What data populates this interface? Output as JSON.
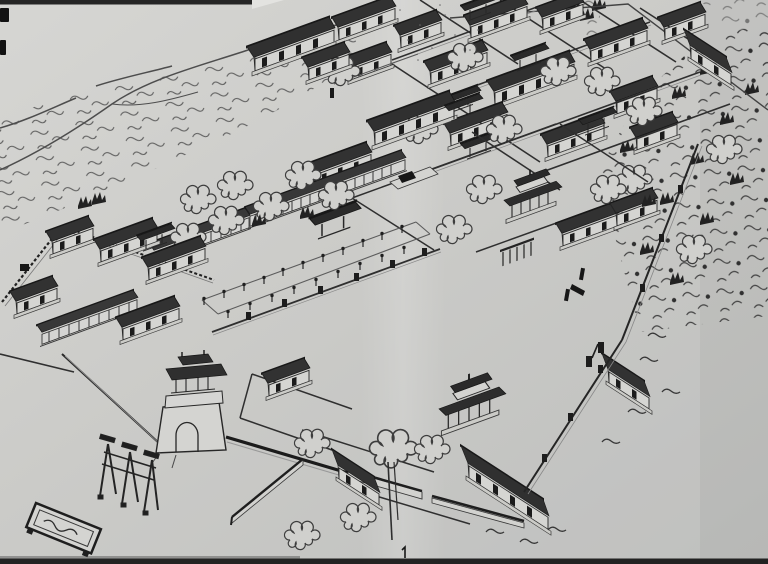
{
  "scene": {
    "aria_label": "Black-and-white photograph of a hand-drawn bird's-eye ink illustration of a traditional Chinese temple complex",
    "description": "Axonometric pen drawing on a book page: walled courtyards on a diagonal axis, approach avenue lined with small posts and side galleries, main gate tower with arched passage, memorial archway, spirit screen, hills at upper left, dense woodland at right",
    "visible_text": [],
    "labels": {
      "paper": "book page paper",
      "fold": "page curvature highlight",
      "photo_edges": "dark photo edge bands",
      "hills": "hill contour lines",
      "scrub": "hillside scrub texture",
      "woods": "dense woodland",
      "frame": "drawing border line",
      "upper_complex": "grid of walled courtyards with halls",
      "middle_complex": "central courtyards with halls",
      "gate_hall": "second gate hall with platform",
      "central_pavilion": "double-eaved central pavilion",
      "avenue": "approach avenue lined with posts",
      "galleries": "side gallery buildings",
      "steles": "small stele markers",
      "left_compound": "walled compound with crenellated wall",
      "gate_tower": "main gate tower with arched passage",
      "paifang": "memorial archway (paifang)",
      "screen_wall": "spirit screen wall",
      "front_walls": "front enclosure walls",
      "lower_complex": "lower courtyards and halls",
      "garden_pavilion": "double-eaved pavilion in lower court",
      "east_wall": "outer boundary wall with piers",
      "big_tree": "large tree with trunk",
      "mark_1": "small stray mark resembling numeral 1"
    },
    "colors": {
      "paper": "#cfcfcc",
      "paper_light": "#dadad7",
      "paper_dark": "#c2c3c1",
      "ink": "#1c1c1c",
      "ink_medium": "#3a3a3a",
      "roof": "#2e2e2e",
      "photo_edge": "#121212"
    }
  }
}
